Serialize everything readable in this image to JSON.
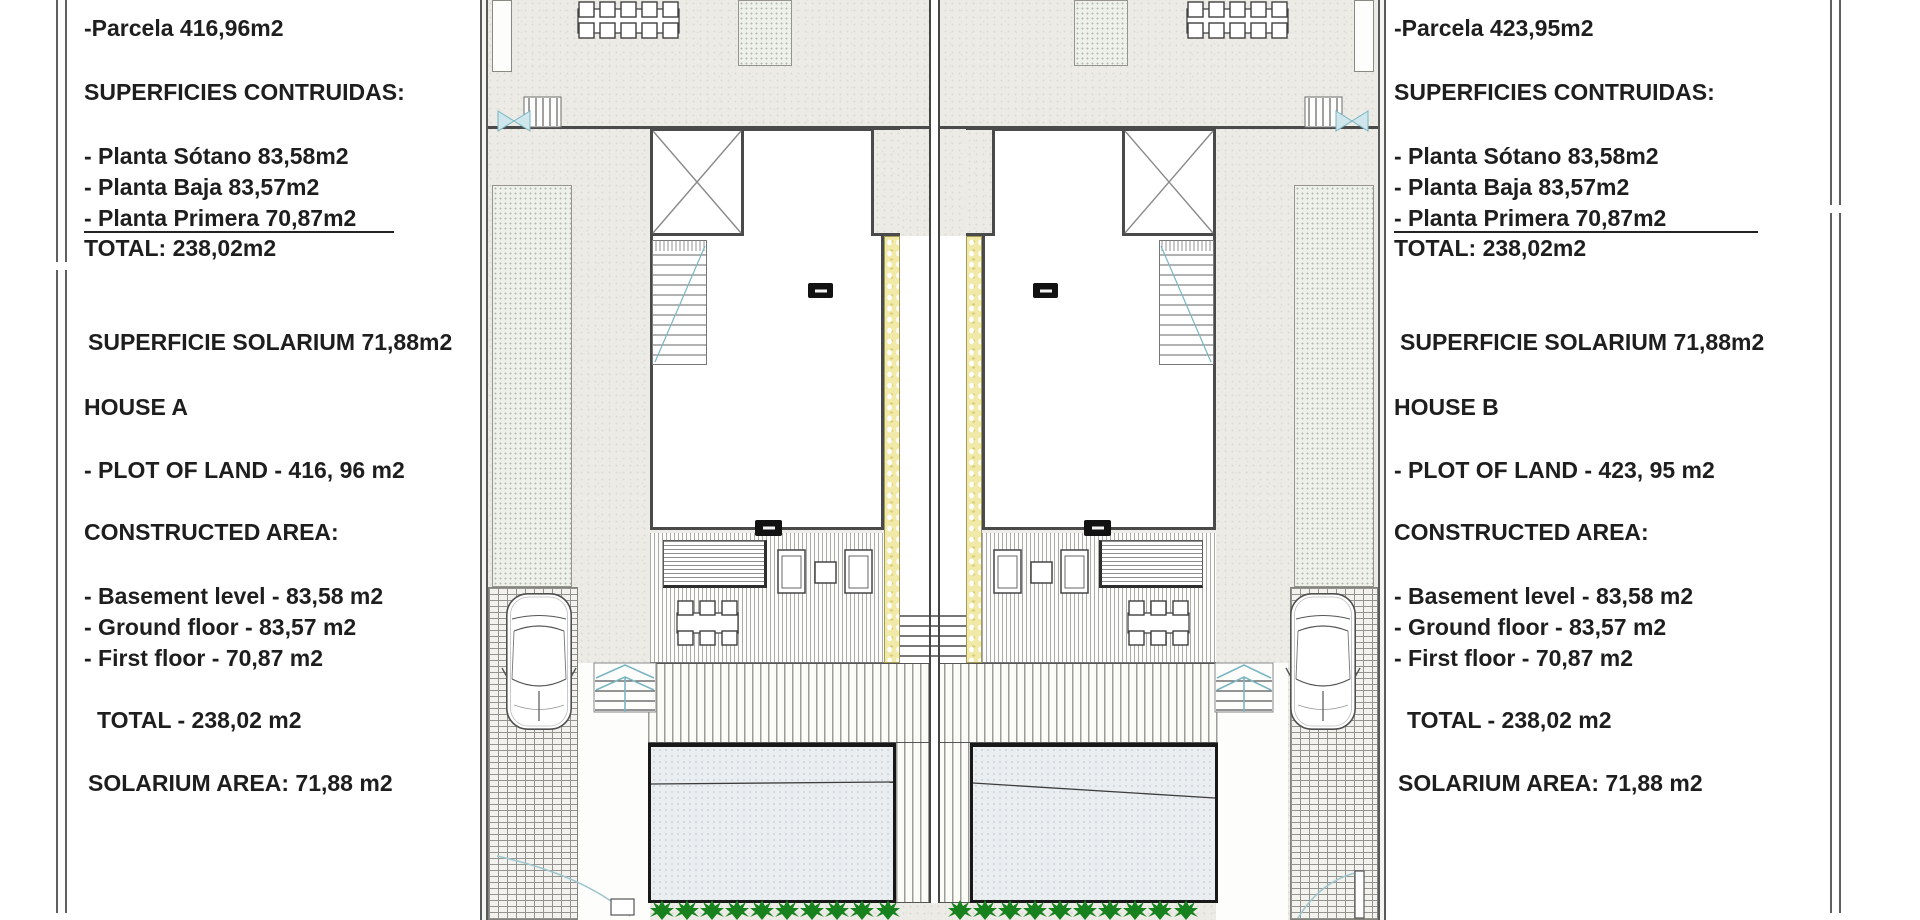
{
  "sheet": {
    "type": "architectural site plan, two semi-detached houses",
    "colors": {
      "text": "#1e1e1e",
      "line_dark": "#4a4a4a",
      "wall_yellow": "#f0e9a8",
      "stair_teal": "#7ab6c2",
      "hedge_green": "#17821d",
      "pool_fill": "#eaeef1"
    }
  },
  "panels": {
    "left": {
      "lines": [
        "-Parcela 416,96m2",
        "SUPERFICIES CONTRUIDAS:",
        "- Planta Sótano 83,58m2",
        "- Planta Baja 83,57m2",
        "- Planta Primera 70,87m2",
        "TOTAL: 238,02m2",
        "SUPERFICIE SOLARIUM 71,88m2",
        "HOUSE A",
        "- PLOT OF LAND - 416, 96 m2",
        "CONSTRUCTED AREA:",
        "- Basement level - 83,58 m2",
        "- Ground floor - 83,57 m2",
        "- First floor - 70,87 m2",
        "TOTAL - 238,02 m2",
        "SOLARIUM AREA: 71,88 m2"
      ]
    },
    "right": {
      "lines": [
        "-Parcela 423,95m2",
        "SUPERFICIES CONTRUIDAS:",
        "- Planta Sótano 83,58m2",
        "- Planta Baja 83,57m2",
        "- Planta Primera 70,87m2",
        "TOTAL: 238,02m2",
        "SUPERFICIE SOLARIUM 71,88m2",
        "HOUSE B",
        "- PLOT OF LAND - 423, 95 m2",
        "CONSTRUCTED AREA:",
        "- Basement level - 83,58 m2",
        "- Ground floor - 83,57 m2",
        "- First floor - 70,87 m2",
        "TOTAL - 238,02 m2",
        "SOLARIUM AREA: 71,88 m2"
      ]
    }
  },
  "plan": {
    "hedge_plants_left": 10,
    "hedge_plants_right": 10,
    "cars": 2,
    "pools": 2
  }
}
